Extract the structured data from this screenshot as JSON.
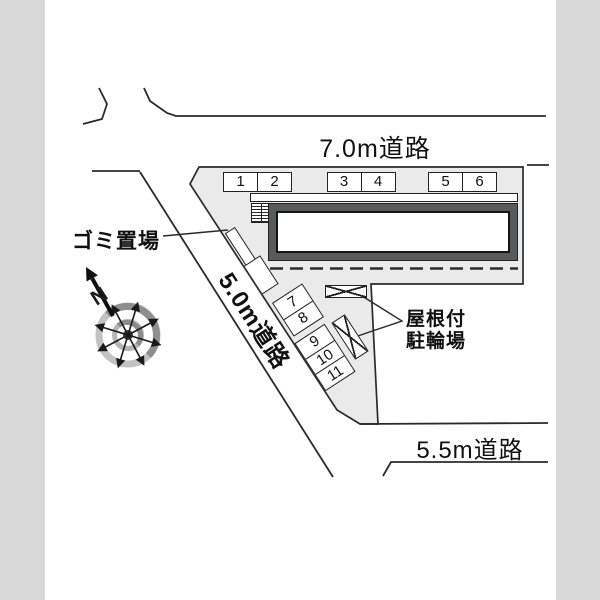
{
  "roads": {
    "top": "7.0m道路",
    "left": "5.0m道路",
    "bottom": "5.5m道路"
  },
  "labels": {
    "garbage": "ゴミ置場",
    "bike_line1": "屋根付",
    "bike_line2": "駐輪場",
    "north": "N"
  },
  "parking": {
    "top_row": [
      "1",
      "2",
      "3",
      "4",
      "5",
      "6"
    ],
    "side_row": [
      "7",
      "8",
      "9",
      "10",
      "11"
    ]
  },
  "colors": {
    "side_strip": "#d8d8d8",
    "parcel_fill": "#eaeaea",
    "building_frame": "#595a5c",
    "line": "#2b2b2b"
  }
}
